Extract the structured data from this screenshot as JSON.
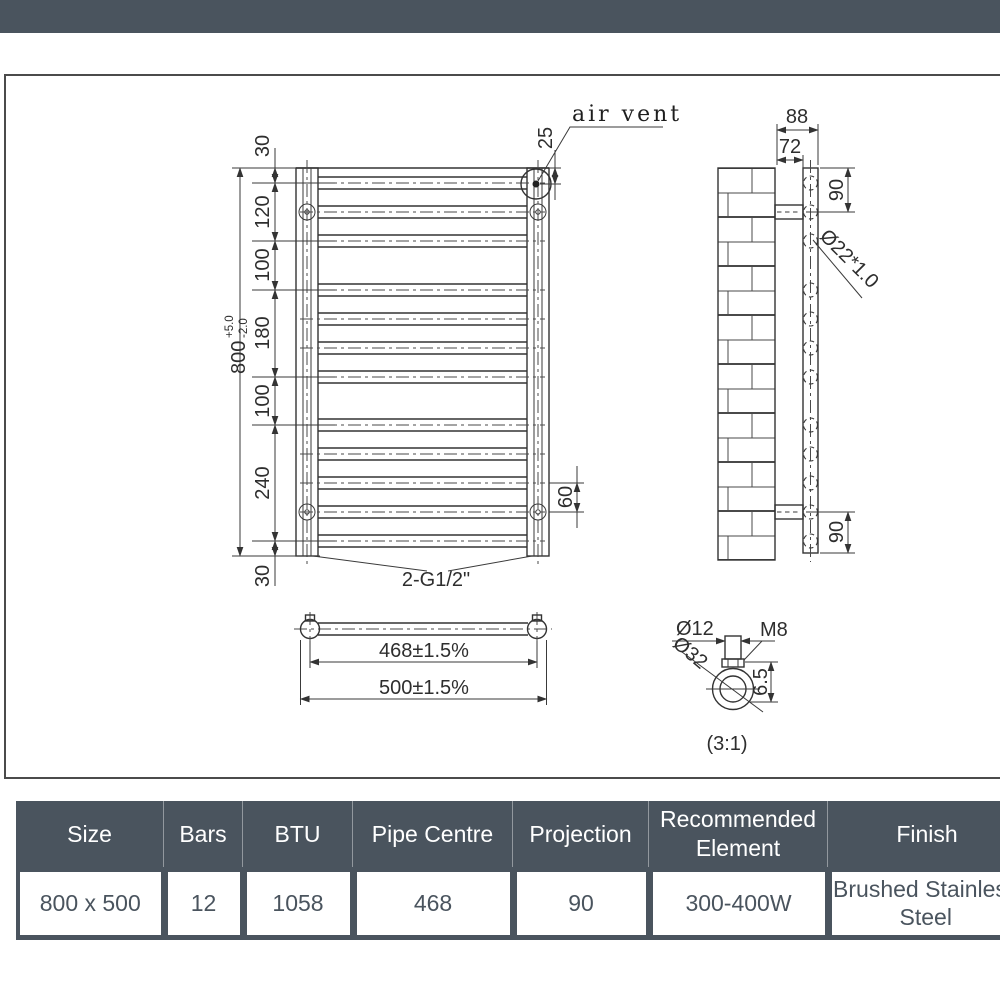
{
  "front_view": {
    "dim_top_gap": "30",
    "dim_120": "120",
    "dim_100_upper": "100",
    "dim_180": "180",
    "dim_100_lower": "100",
    "dim_240": "240",
    "dim_bottom_gap": "30",
    "overall_height": "800",
    "tol_plus": "+5.0",
    "tol_minus": "-2.0",
    "air_vent_label": "air vent",
    "dim_air_vent": "25",
    "dim_bracket": "60",
    "connections": "2-G1/2\""
  },
  "side_view": {
    "dim_bracket_depth": "88",
    "dim_bracket_inner": "72",
    "dim_90_top": "90",
    "dim_90_bottom": "90",
    "tube_spec": "Ø22*1.0"
  },
  "top_view": {
    "pipe_centres": "468±1.5%",
    "overall_width": "500±1.5%"
  },
  "detail_view": {
    "dim_stem": "Ø12",
    "thread": "M8",
    "dim_outer": "Ø32",
    "dim_nut": "6.5",
    "scale_label": "(3:1)"
  },
  "spec_table": {
    "columns": [
      "Size",
      "Bars",
      "BTU",
      "Pipe Centre",
      "Projection",
      "Recommended Element",
      "Finish"
    ],
    "values": [
      "800 x 500",
      "12",
      "1058",
      "468",
      "90",
      "300-400W",
      "Brushed Stainless Steel"
    ]
  },
  "colors": {
    "slate": "#4a545e",
    "line": "#333333"
  }
}
